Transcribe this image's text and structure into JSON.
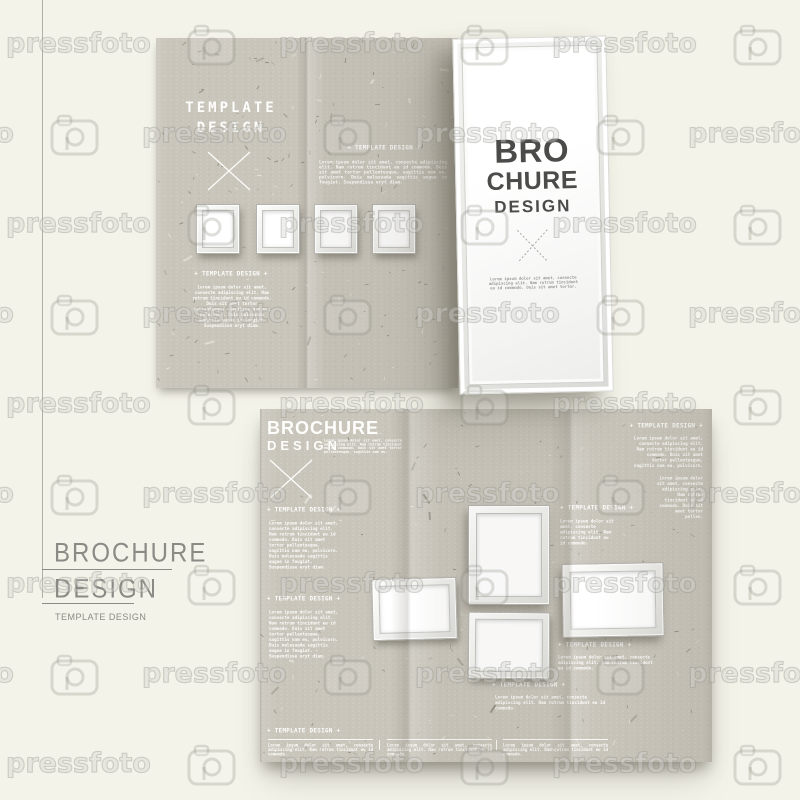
{
  "watermark": {
    "text": "pressfoto",
    "icon": "camera-logo-icon"
  },
  "colors": {
    "page_background": "#f3f3e9",
    "kraft_paper": "#c9c5bb",
    "white_panel": "#ffffff",
    "template_text": "#fdfdfb",
    "cover_title_text": "#4b4b49",
    "caption_text": "#8b8b86"
  },
  "left_caption": {
    "line1": "BROCHURE",
    "line2": "DESIGN",
    "subtitle": "TEMPLATE DESIGN"
  },
  "top_brochure": {
    "panel_left": {
      "title_line1": "TEMPLATE",
      "title_line2": "DESIGN",
      "section_heading": "+ TEMPLATE DESIGN +",
      "section_body": "Lorem ipsum dolor sit amet, consecte adipiscing elit. Nam rutrum tincidunt eu id commodo. Duis sit amet tortor pellentesque, sagittis nam eu, pulvicorn. Duis malesuada sagittis augue in feugiat. Suspendisse eryt diam."
    },
    "panel_middle": {
      "heading": "+ TEMPLATE DESIGN +",
      "body": "Lorem ipsum dolor sit amet, consecte adipiscing elit. Nam rutrum tincidunt eu id commodo. Duis sit amet tortor pellentesque, sagittis nam eu, pulvicorn. Duis malesuada sagittis augue in feugiat. Suspendisse eryt diam."
    },
    "cover_panel": {
      "word1": "BRO",
      "word2": "CHURE",
      "word3": "DESIGN",
      "note": "Lorem ipsum dolor sit amet, consecte adipiscing elit. Nam rutrum tincidunt eu id commodo. Duis sit amet tortor."
    }
  },
  "bottom_brochure": {
    "title": "BROCHURE",
    "subtitle": "DESIGN",
    "intro": "Lorem ipsum dolor sit amet, consecte adipiscing elit. Nam rutrum tincidunt eu id commodo. Duis sit amet tortor pellentesque, sagittis nam eu.",
    "left": {
      "h1": "+ TEMPLATE DESIGN +",
      "p1": "Lorem ipsum dolor sit amet, consecte adipiscing elit. Nam rutrum tincidunt eu id commodo. Duis sit amet tortor pellentesque, sagittis nam eu, pulvicorn. Duis malesuada sagittis augue in feugiat. Suspendisse eryt diam.",
      "h2": "+ TEMPLATE DESIGN +",
      "p2": "Lorem ipsum dolor sit amet, consecte adipiscing elit. Nam rutrum tincidunt eu id commodo. Duis sit amet tortor pellentesque, sagittis nam eu, pulvicorn. Duis malesuada sagittis augue in feugiat. Suspendisse eryt diam.",
      "h3": "+ TEMPLATE DESIGN +"
    },
    "middle": {
      "h1": "+ TEMPLATE DESIGN +",
      "p1": "Lorem ipsum dolor sit amet, consecte adipiscing elit. Nam rutrum tincidunt eu id commodo.",
      "h2": "+ TEMPLATE DESIGN +",
      "p2": "Lorem ipsum dolor sit amet, consecte adipiscing elit. Nam rutrum tincidunt eu id commodo.",
      "h3": "+ TEMPLATE DESIGN +",
      "p3": "Lorem ipsum dolor sit amet, consecte adipiscing elit. Nam rutrum tincidunt eu id commodo."
    },
    "right": {
      "h1": "+ TEMPLATE DESIGN +",
      "p1": "Lorem ipsum dolor sit amet, consecte adipiscing elit. Nam rutrum tincidunt eu id commodo. Duis sit amet tortor pellentesque, sagittis nam eu, pulvicorn.",
      "p2": "Lorem ipsum dolor sit amet, consecte adipiscing elit. Nam rutrum tincidunt eu id commodo. Duis sit amet tortor pellen."
    },
    "footer": {
      "col1": "Lorem ipsum dolor sit amet, consecte adipiscing elit. Nam rutrum tincidunt eu id commodo.",
      "col2": "Lorem ipsum dolor sit amet, consecte adipiscing elit. Nam rutrum tincidunt eu id commodo.",
      "col3": "Lorem ipsum dolor sit amet, consecte adipiscing elit. Nam rutrum tincidunt eu id commodo."
    }
  }
}
